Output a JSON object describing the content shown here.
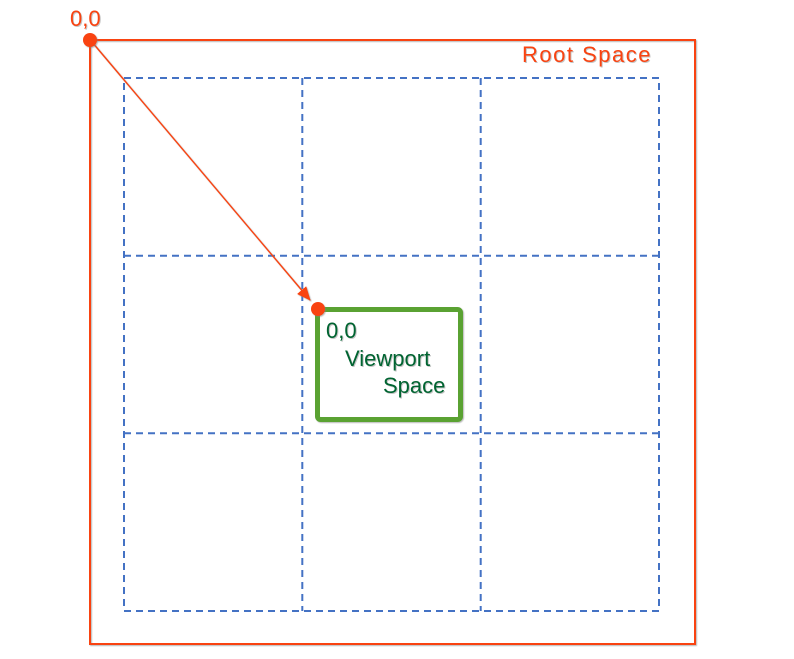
{
  "root_space": {
    "label": "Root Space",
    "origin_label": "0,0"
  },
  "viewport_space": {
    "origin_label": "0,0",
    "label_lines": [
      "Viewport",
      "Space"
    ]
  },
  "grid": {
    "rows": 3,
    "columns": 3,
    "style": "dashed"
  },
  "colors": {
    "accent_orange": "#f94311",
    "grid_blue": "#4472c4",
    "viewport_green": "#5aa232",
    "viewport_text_green": "#006431",
    "background": "#ffffff"
  }
}
